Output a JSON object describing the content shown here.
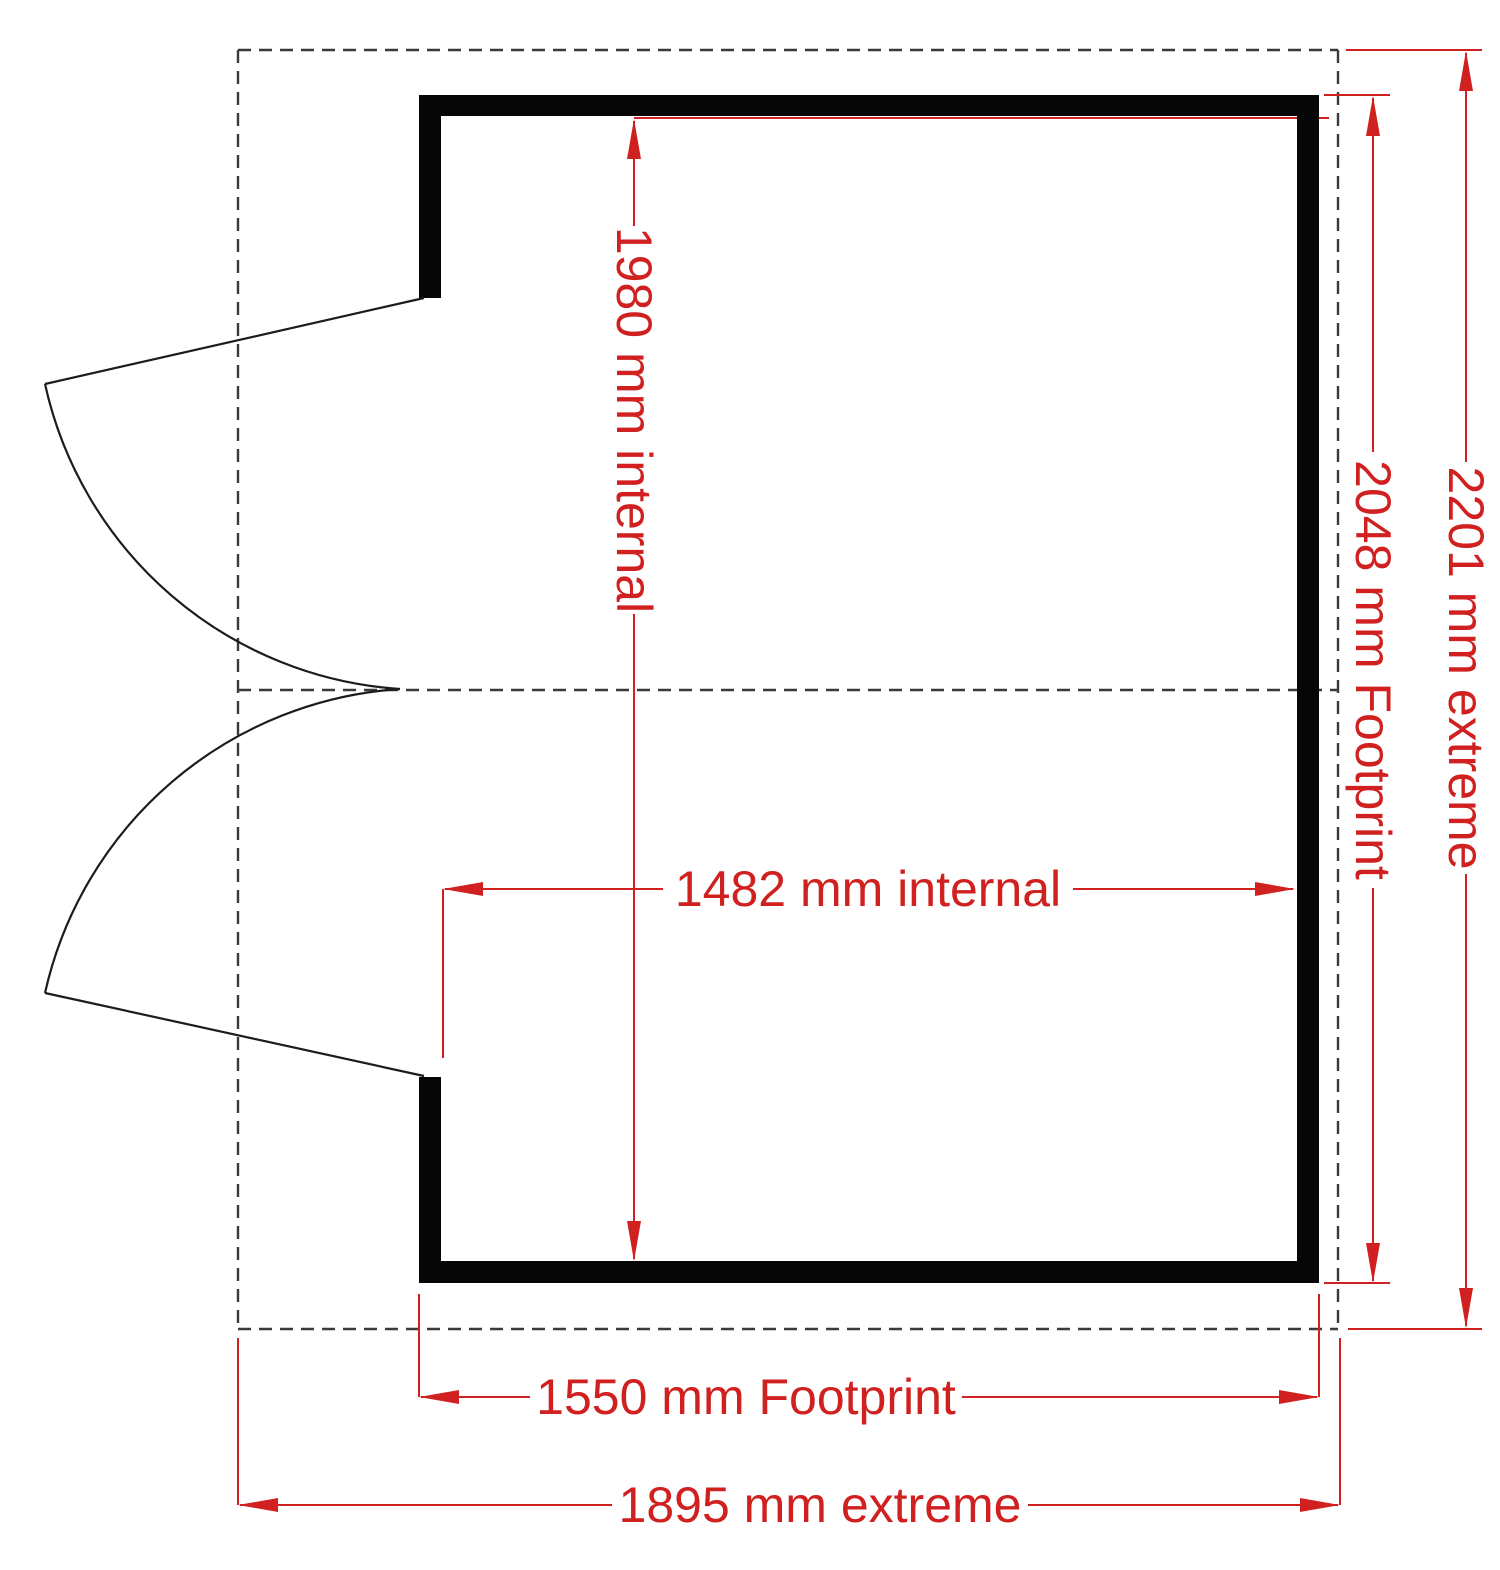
{
  "drawing": {
    "kind": "floor-plan",
    "units": "mm"
  },
  "dimensions": {
    "internal_depth": {
      "label": "1980 mm internal",
      "value_mm": 1980,
      "orientation": "vertical"
    },
    "internal_width": {
      "label": "1482 mm internal",
      "value_mm": 1482,
      "orientation": "horizontal"
    },
    "footprint_depth": {
      "label": "2048 mm Footprint",
      "value_mm": 2048,
      "orientation": "vertical"
    },
    "extreme_depth": {
      "label": "2201 mm extreme",
      "value_mm": 2201,
      "orientation": "vertical"
    },
    "footprint_width": {
      "label": "1550 mm Footprint",
      "value_mm": 1550,
      "orientation": "horizontal"
    },
    "extreme_width": {
      "label": "1895 mm extreme",
      "value_mm": 1895,
      "orientation": "horizontal"
    }
  },
  "colors": {
    "dimension_red": "#d02020",
    "wall_black": "#060606",
    "dash_gray": "#3a3a3a",
    "background": "#ffffff"
  }
}
